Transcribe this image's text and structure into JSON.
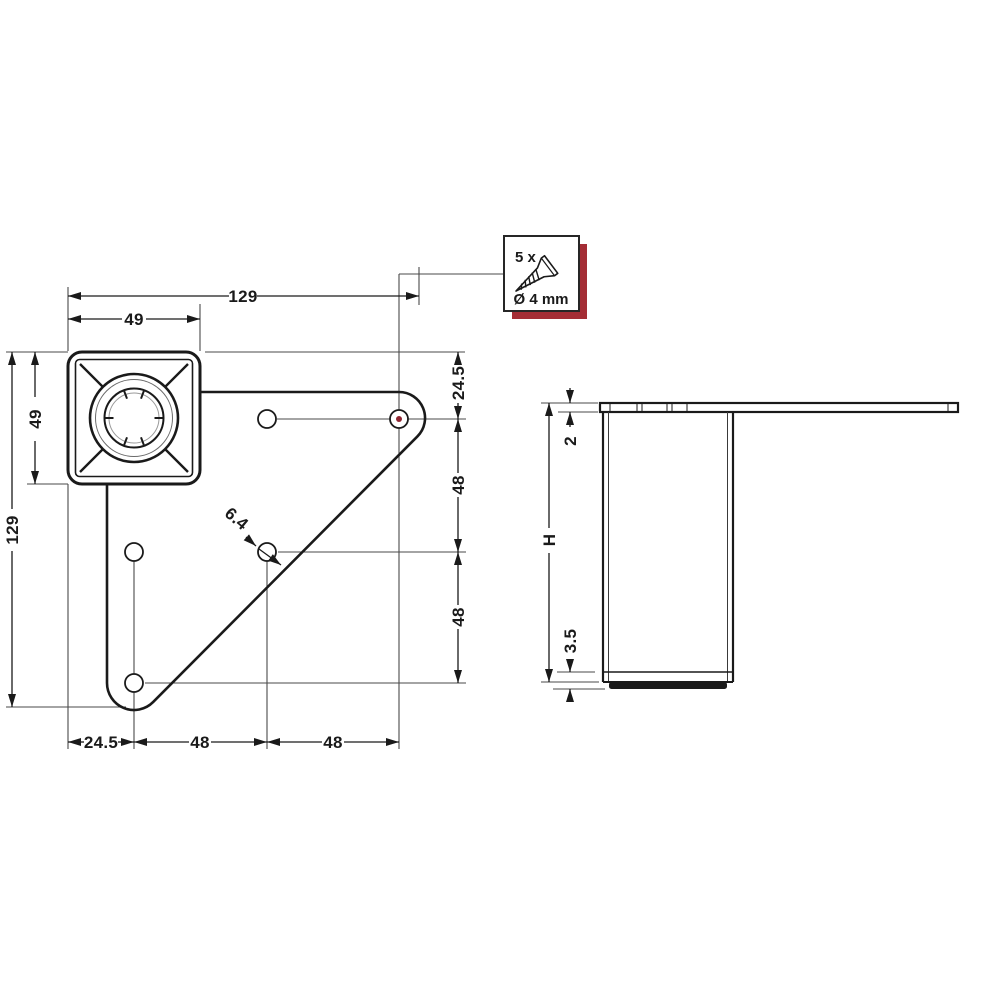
{
  "screw_callout": {
    "quantity": "5 x",
    "diameter": "Ø 4 mm"
  },
  "top_view": {
    "dim_total_width": "129",
    "dim_socket_width": "49",
    "dim_socket_height": "49",
    "dim_total_height": "129",
    "dim_hole_diameter": "6.4",
    "right_chain": {
      "top": "24.5",
      "mid": "48",
      "bottom": "48"
    },
    "bottom_chain": {
      "left": "24.5",
      "mid": "48",
      "right": "48"
    }
  },
  "side_view": {
    "dim_plate_thickness": "2",
    "dim_height": "H",
    "dim_foot": "3.5"
  },
  "colors": {
    "line": "#1a1a1a",
    "thin_line": "#4a4a4a",
    "accent_red": "#a42d35",
    "hole_marker_red": "#8e2430"
  }
}
